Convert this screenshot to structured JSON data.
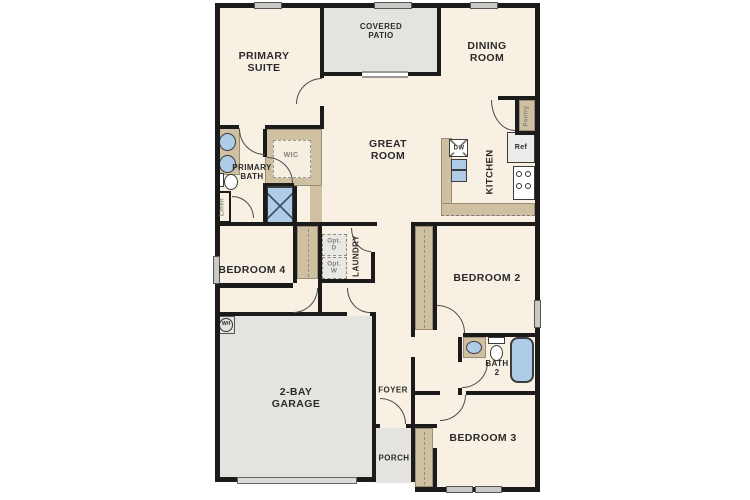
{
  "rooms": {
    "primary_suite": "PRIMARY\nSUITE",
    "covered_patio": "COVERED\nPATIO",
    "dining_room": "DINING\nROOM",
    "great_room": "GREAT\nROOM",
    "kitchen": "KITCHEN",
    "primary_bath": "PRIMARY\nBATH",
    "wic": "WIC",
    "linen": "Linen",
    "pantry": "Pantry",
    "laundry": "LAUNDRY",
    "bedroom_4": "BEDROOM 4",
    "bedroom_2": "BEDROOM 2",
    "bedroom_3": "BEDROOM 3",
    "bath_2": "BATH\n2",
    "garage": "2-BAY\nGARAGE",
    "foyer": "FOYER",
    "porch": "PORCH"
  },
  "appliances": {
    "dishwasher": "DW",
    "refrigerator": "Ref",
    "water_heater": "WH",
    "optional_dryer": "Opt.\nD",
    "optional_washer": "Opt.\nW"
  },
  "colors": {
    "wall": "#1b1b1b",
    "interior": "#f8f0e2",
    "outdoor": "#e4e3e0",
    "cabinetry": "#cfc0a2",
    "fixture_blue": "#aecbe8",
    "label_text": "#2b2b2b",
    "secondary_text": "#83837b"
  }
}
